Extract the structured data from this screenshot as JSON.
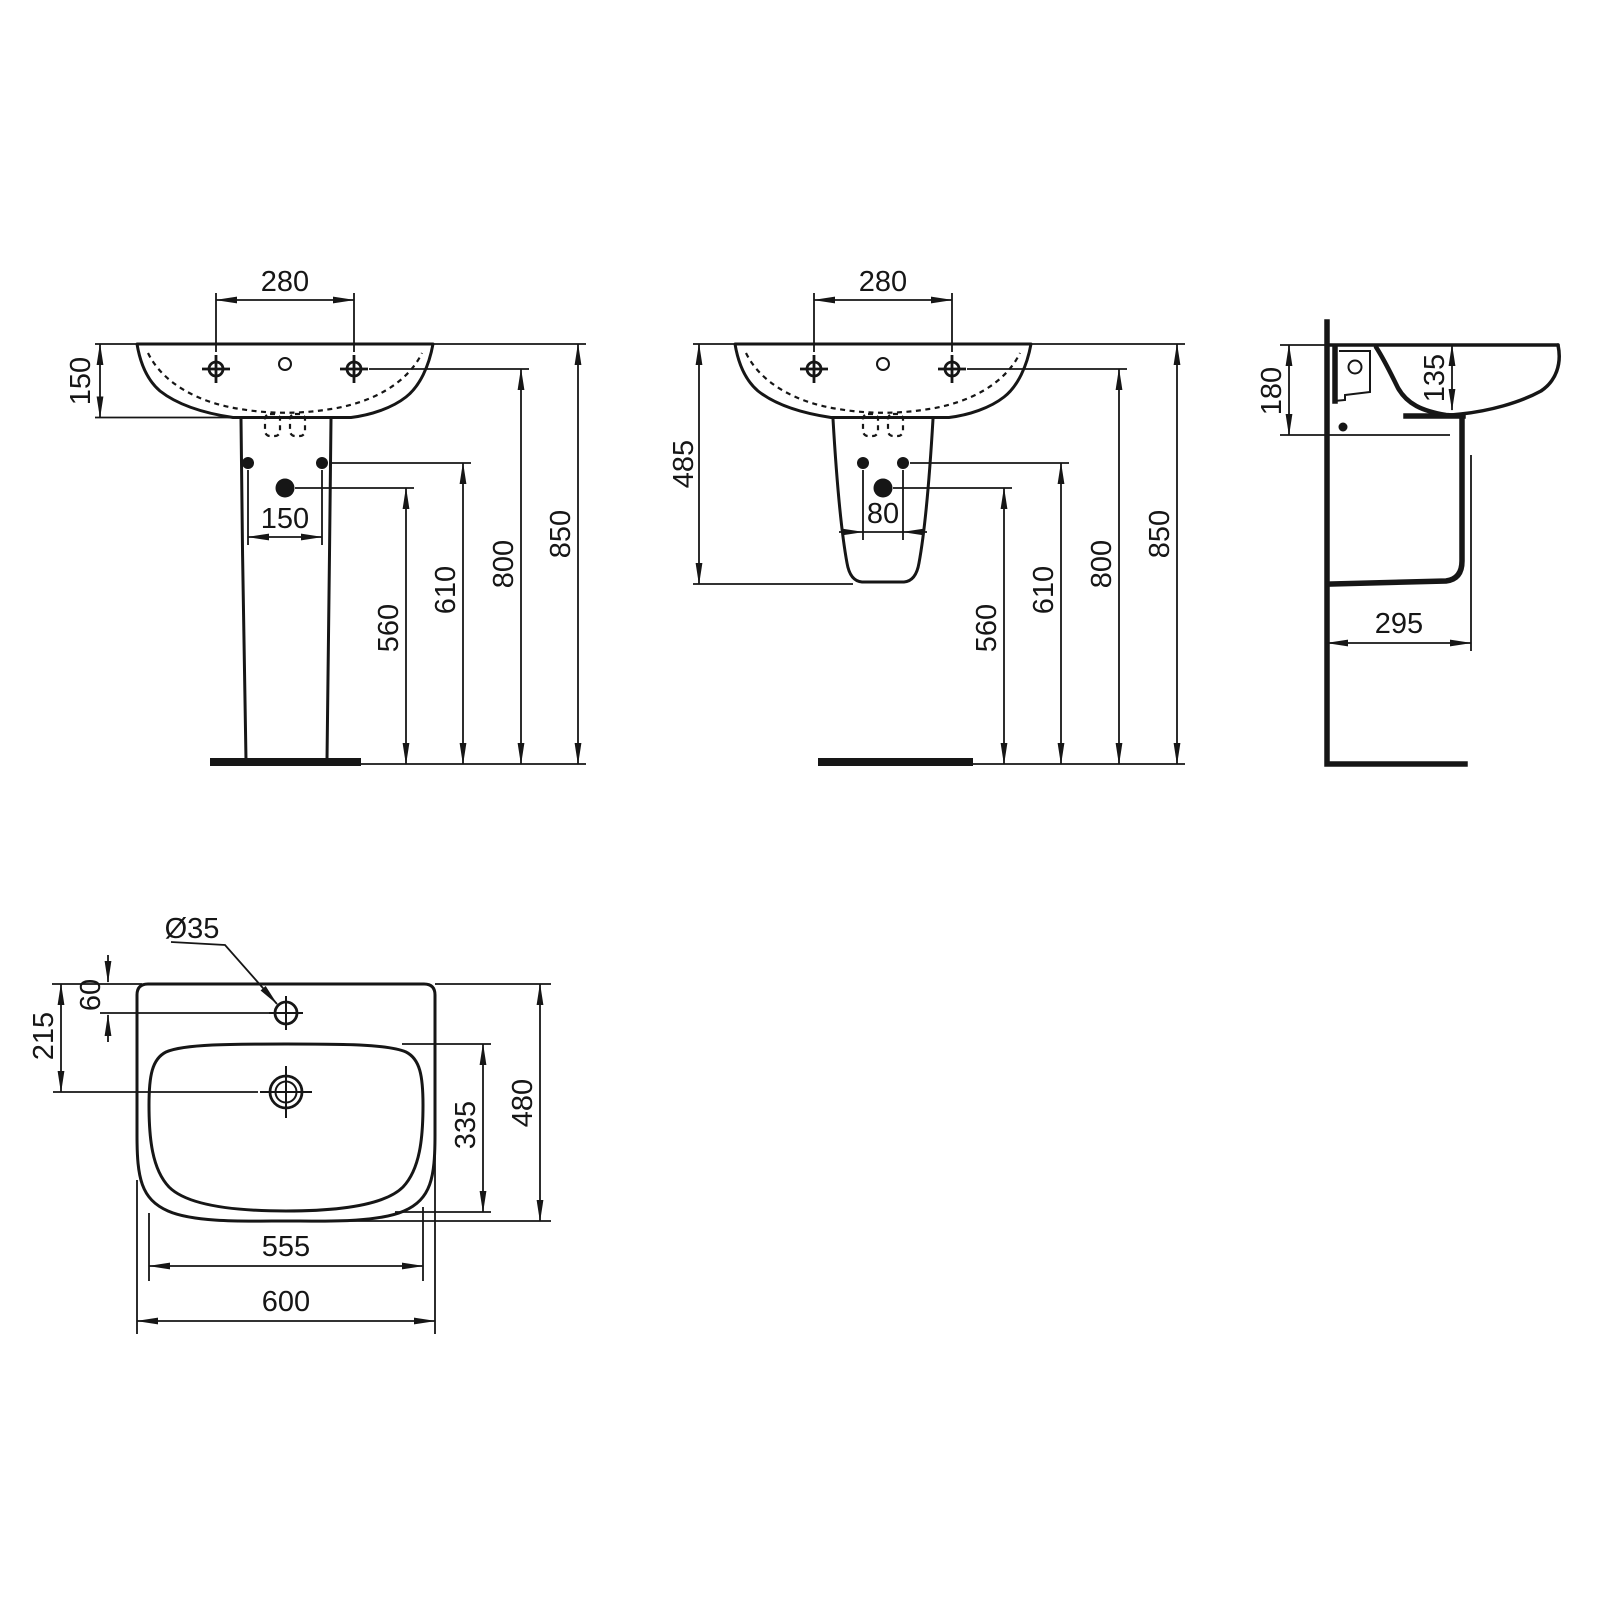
{
  "views": {
    "front_pedestal": {
      "tap_spacing": "280",
      "rim_depth": "150",
      "bolt_spacing": "150",
      "drain_height": "560",
      "bolt_height": "610",
      "tap_height": "800",
      "rim_height": "850"
    },
    "front_semi": {
      "tap_spacing": "280",
      "semi_height": "485",
      "bolt_spacing": "80",
      "drain_height": "560",
      "bolt_height": "610",
      "tap_height": "800",
      "rim_height": "850"
    },
    "side": {
      "fixing_depth": "180",
      "bowl_depth": "135",
      "semi_depth": "295"
    },
    "plan": {
      "tap_hole": "Ø35",
      "tap_offset": "60",
      "drain_offset": "215",
      "bowl_length": "335",
      "overall_depth": "480",
      "bowl_width": "555",
      "overall_width": "600"
    }
  }
}
